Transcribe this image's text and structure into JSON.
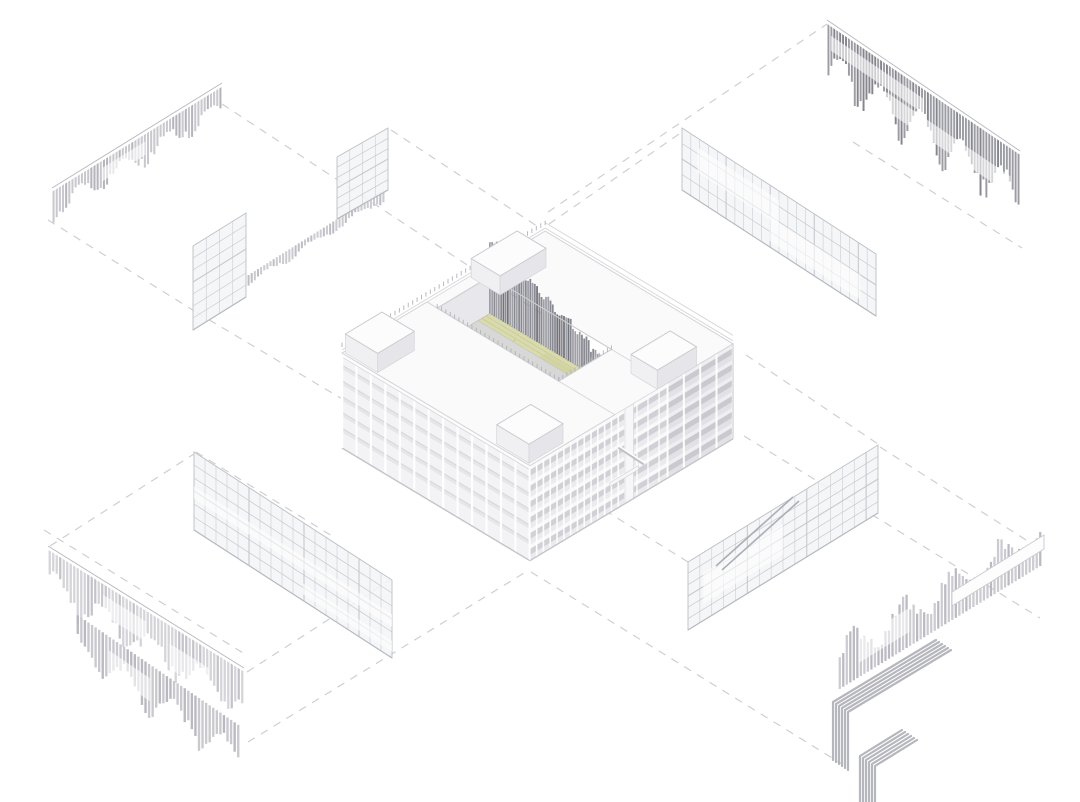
{
  "meta": {
    "title": "Exploded axonometric facade diagram",
    "description": "Architectural exploded axonometric: central U-shaped building model with green courtyard deck and tall vertical louver screen; four detached facade assemblies (louver screens and gridded curtain-wall panels) pulled out to the corners, linked by dashed projection lines."
  },
  "palette": {
    "background": "#ffffff",
    "guide": "#cdcdd1",
    "outline": "#c9c9ce",
    "roof": "#fafafb",
    "facadeSW": "#f2f2f5",
    "facadeSE": "#ebebee",
    "slabShadow": "#cdcdd3",
    "slabLight": "#f9f9fb",
    "mullion": "#ffffff",
    "deck": "#d9dbac",
    "deckLine": "#c6c89c",
    "walkway": "#d8d8da",
    "courtFin1": "#6c6c74",
    "courtFin2": "#84848d",
    "courtFin3": "#9b9ba3",
    "teeth": "#b2b2b9",
    "glassFill": "rgba(243,244,247,0.85)",
    "glassLine": "#c6c9cf",
    "glassBorder": "#bcbfc5",
    "stair": "#a9acb4",
    "bundle": "#aeaeb6"
  },
  "canvas": {
    "w": 1080,
    "h": 802
  },
  "guides": {
    "dash": "8 7",
    "width": 1.2,
    "lines": [
      [
        222,
        104,
        548,
        318
      ],
      [
        48,
        220,
        196,
        312
      ],
      [
        196,
        312,
        344,
        400
      ],
      [
        391,
        130,
        543,
        230
      ],
      [
        548,
        212,
        827,
        24
      ],
      [
        549,
        224,
        682,
        132
      ],
      [
        853,
        142,
        1022,
        248
      ],
      [
        50,
        546,
        194,
        454
      ],
      [
        248,
        742,
        529,
        570
      ],
      [
        196,
        452,
        332,
        536
      ],
      [
        247,
        672,
        390,
        580
      ],
      [
        44,
        530,
        248,
        656
      ],
      [
        744,
        436,
        1040,
        618
      ],
      [
        531,
        572,
        842,
        764
      ],
      [
        688,
        562,
        556,
        480
      ],
      [
        880,
        447,
        1037,
        547
      ],
      [
        746,
        355,
        878,
        444
      ]
    ]
  },
  "building": {
    "origin": [
      342,
      448
    ],
    "kx": 0.85,
    "ky": 0.51,
    "H": 95,
    "floorH": 15.8,
    "aW": 239,
    "bD": 221,
    "parapetZ": 101,
    "slot": {
      "a1": 100,
      "a2": 162,
      "b1": 12,
      "b2": 155,
      "deckZ": 58
    },
    "courtFins": {
      "a": 162,
      "b1": 12,
      "b2": 152,
      "n": 54,
      "topZ1": 130,
      "topZ2": 75
    },
    "walkway": [
      126,
      148
    ],
    "pier": [
      112,
      122
    ],
    "diagonal": [
      104,
      60,
      134,
      28
    ],
    "canopy": [
      94,
      128,
      26,
      30
    ],
    "boxes": [
      [
        2,
        45,
        2,
        40
      ],
      [
        2,
        42,
        180,
        218
      ],
      [
        150,
        204,
        2,
        36
      ],
      [
        150,
        196,
        190,
        221
      ]
    ],
    "boxTopZ": 114,
    "swCols": 14,
    "swColStep": 17,
    "seColStepLeft": 8,
    "seColStepRight": 19.2
  },
  "panels": [
    {
      "name": "louver-screen-top-left",
      "kind": "fin-row",
      "rail": [
        52,
        190,
        222,
        85
      ],
      "len": 30,
      "dir": 1,
      "n": 54,
      "color": "#c6c6cc",
      "alt": "#b0b0b8",
      "topBar": true,
      "seed": 1,
      "streaks": [
        [
          0.3,
          0.55,
          0.3,
          0.75
        ]
      ]
    },
    {
      "name": "balustrade-screen-top-left",
      "kind": "fin-row",
      "rail": [
        247,
        276,
        385,
        189
      ],
      "len": 12,
      "dir": 1,
      "n": 44,
      "color": "#c9c9cf",
      "alt": "#bbbbc2",
      "topBar": false,
      "seed": 2,
      "streaks": []
    },
    {
      "name": "glass-panel-top-left-upper",
      "kind": "grid-panel",
      "tl": [
        337,
        157
      ],
      "tr": [
        388,
        128
      ],
      "h": 62,
      "cols": 4,
      "rows": 6,
      "streaks": [],
      "stairs": []
    },
    {
      "name": "glass-panel-top-left-lower",
      "kind": "grid-panel",
      "tl": [
        193,
        246
      ],
      "tr": [
        246,
        213
      ],
      "h": 84,
      "cols": 4,
      "rows": 7,
      "streaks": [],
      "stairs": []
    },
    {
      "name": "louver-screen-top-right",
      "kind": "fin-row",
      "rail": [
        827,
        22,
        1020,
        153
      ],
      "len": 62,
      "dir": 1,
      "n": 66,
      "color": "#97979f",
      "alt": "#7f7f88",
      "topBar": true,
      "seed": 3,
      "streaks": [
        [
          0.02,
          0.5,
          0.18,
          0.42
        ],
        [
          0.3,
          0.95,
          0.48,
          0.78
        ]
      ]
    },
    {
      "name": "curtain-wall-top-right",
      "kind": "grid-panel",
      "tl": [
        682,
        128
      ],
      "tr": [
        876,
        254
      ],
      "h": 62,
      "cols": 22,
      "rows": 4,
      "streaks": [
        [
          0.08,
          0.5,
          0.15,
          0.55
        ],
        [
          0.45,
          0.92,
          0.5,
          0.9
        ]
      ],
      "stairs": []
    },
    {
      "name": "curtain-wall-bottom-left",
      "kind": "grid-panel",
      "tl": [
        194,
        452
      ],
      "tr": [
        392,
        580
      ],
      "h": 78,
      "cols": 18,
      "rows": 6,
      "streaks": [
        [
          0.0,
          1.0,
          0.44,
          0.6
        ],
        [
          0.55,
          1.0,
          0.78,
          0.92
        ]
      ],
      "stairs": []
    },
    {
      "name": "louver-screen-bottom-left-upper",
      "kind": "fin-row",
      "rail": [
        48,
        548,
        244,
        670
      ],
      "len": 50,
      "dir": 1,
      "n": 56,
      "color": "#d2d2d7",
      "alt": "#c0c0c7",
      "topBar": true,
      "seed": 4,
      "streaks": [
        [
          0.28,
          0.5,
          0.25,
          0.65
        ],
        [
          0.62,
          0.82,
          0.4,
          0.9
        ]
      ]
    },
    {
      "name": "louver-screen-bottom-left-lower",
      "kind": "fin-row",
      "rail": [
        76,
        614,
        240,
        726
      ],
      "len": 46,
      "dir": 1,
      "n": 46,
      "color": "#c7c7cd",
      "alt": "#b6b6bd",
      "topBar": false,
      "seed": 5,
      "streaks": [
        [
          0.2,
          0.45,
          0.3,
          0.8
        ]
      ]
    },
    {
      "name": "curtain-wall-bottom-right",
      "kind": "grid-panel",
      "tl": [
        688,
        562
      ],
      "tr": [
        878,
        445
      ],
      "h": 68,
      "cols": 16,
      "rows": 6,
      "streaks": [
        [
          0.08,
          0.5,
          0.3,
          0.75
        ]
      ],
      "stairs": [
        [
          793,
          497,
          716,
          566
        ],
        [
          799,
          501,
          722,
          570
        ]
      ]
    },
    {
      "name": "louver-screen-bottom-right",
      "kind": "fin-row",
      "rail": [
        838,
        690,
        1042,
        565
      ],
      "len": 48,
      "dir": -1,
      "n": 58,
      "color": "#c9c9cf",
      "alt": "#b7b7bf",
      "topBar": false,
      "seed": 6,
      "streaks": [
        [
          0.1,
          0.35,
          0.3,
          0.8
        ]
      ]
    }
  ],
  "caps": [
    {
      "name": "louver-cap-bottom-right",
      "points": [
        [
          952,
          606
        ],
        [
          1044,
          549
        ],
        [
          1044,
          535
        ],
        [
          952,
          592
        ]
      ],
      "fill": "#fdfdfe",
      "stroke": "#c9c9cf"
    }
  ],
  "bundles": [
    {
      "name": "handrail-bundle-upper",
      "count": 6,
      "stepX": 3,
      "stepY": 2,
      "points": [
        [
          833,
          760
        ],
        [
          833,
          702
        ],
        [
          936,
          640
        ]
      ],
      "width": 2.2
    },
    {
      "name": "handrail-bundle-lower",
      "count": 6,
      "stepX": 3,
      "stepY": 2,
      "points": [
        [
          860,
          810
        ],
        [
          860,
          756
        ],
        [
          902,
          730
        ]
      ],
      "width": 2.2
    }
  ]
}
